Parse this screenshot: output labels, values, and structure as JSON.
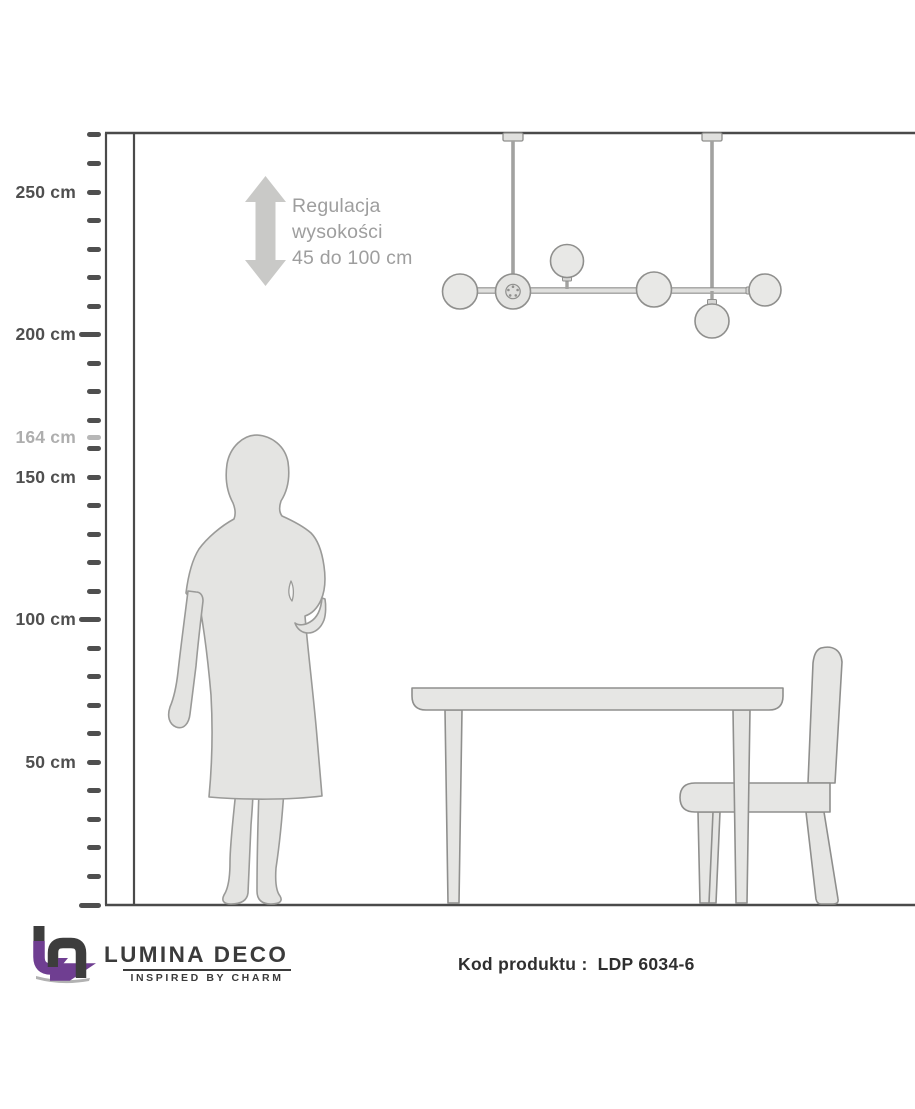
{
  "scale": {
    "unit": "cm",
    "max_cm": 270,
    "step_cm": 10,
    "long_tick_cms": [
      200,
      100,
      0
    ],
    "extra_tick_cm": 164,
    "labels": [
      {
        "text": "250 cm",
        "cm": 250,
        "muted": false
      },
      {
        "text": "200 cm",
        "cm": 200,
        "muted": false
      },
      {
        "text": "164 cm",
        "cm": 164,
        "muted": true
      },
      {
        "text": "150 cm",
        "cm": 150,
        "muted": false
      },
      {
        "text": "100 cm",
        "cm": 100,
        "muted": false
      },
      {
        "text": "50 cm",
        "cm": 50,
        "muted": false
      }
    ]
  },
  "annotation": {
    "lines": [
      "Regulacja",
      "wysokości",
      "45 do 100 cm"
    ]
  },
  "lamp": {
    "ball_count": 6,
    "suspension_rods": 2
  },
  "footer": {
    "brand": "LUMINA DECO",
    "tagline": "INSPIRED BY CHARM",
    "product_label": "Kod produktu :",
    "product_code": "LDP 6034-6"
  },
  "colors": {
    "accent_purple": "#6f3e91",
    "ink": "#3b3b3b",
    "ruler_tick": "#4f4f4f",
    "muted_label": "#aeaeae",
    "annotation_text": "#9e9e9e",
    "arrow_gray": "#c9c9c7",
    "room_line": "#4a4a4a",
    "shape_fill": "#e6e6e4",
    "shape_stroke": "#979795"
  }
}
